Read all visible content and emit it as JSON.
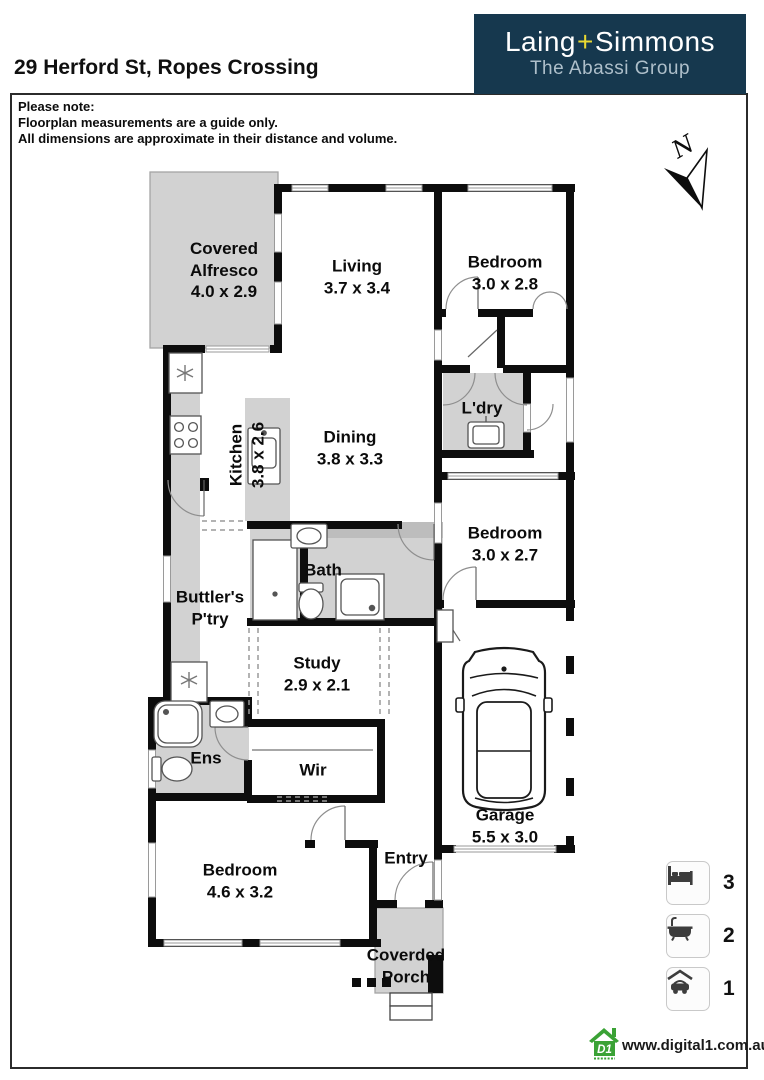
{
  "header": {
    "title": "29 Herford St, Ropes Crossing",
    "brand": {
      "left": "Laing",
      "plus": "+",
      "right": "Simmons",
      "subtitle": "The Abassi Group"
    }
  },
  "note": [
    "Please note:",
    "Floorplan measurements are a guide only.",
    "All dimensions are approximate in their distance and volume."
  ],
  "compass": {
    "label": "N"
  },
  "rooms": {
    "alfresco": {
      "name": "Covered Alfresco",
      "dims": "4.0 x 2.9"
    },
    "living": {
      "name": "Living",
      "dims": "3.7 x 3.4"
    },
    "bedroom1": {
      "name": "Bedroom",
      "dims": "3.0 x 2.8"
    },
    "kitchen": {
      "name": "Kitchen",
      "dims": "3.8 x 2.6"
    },
    "dining": {
      "name": "Dining",
      "dims": "3.8 x 3.3"
    },
    "laundry": {
      "name": "L'dry"
    },
    "bedroom2": {
      "name": "Bedroom",
      "dims": "3.0 x 2.7"
    },
    "bath": {
      "name": "Bath"
    },
    "butlers": {
      "name": "Buttler's P'try"
    },
    "study": {
      "name": "Study",
      "dims": "2.9 x 2.1"
    },
    "ens": {
      "name": "Ens"
    },
    "wir": {
      "name": "Wir"
    },
    "garage": {
      "name": "Garage",
      "dims": "5.5 x 3.0"
    },
    "bedroom3": {
      "name": "Bedroom",
      "dims": "4.6 x 3.2"
    },
    "entry": {
      "name": "Entry"
    },
    "porch": {
      "name": "Coverded Porch"
    }
  },
  "legend": {
    "beds": {
      "icon": "bed-icon",
      "count": "3"
    },
    "baths": {
      "icon": "bath-icon",
      "count": "2"
    },
    "cars": {
      "icon": "car-icon",
      "count": "1"
    }
  },
  "footer": {
    "logo_text": "D1",
    "website": "www.digital1.com.au"
  },
  "colors": {
    "wall": "#0d0d0d",
    "room_fill": "#d2d2d2",
    "brand_navy": "#16384e",
    "brand_plus": "#e8d832",
    "brand_subtitle": "#aebfca",
    "digital1_green": "#3aa235"
  }
}
